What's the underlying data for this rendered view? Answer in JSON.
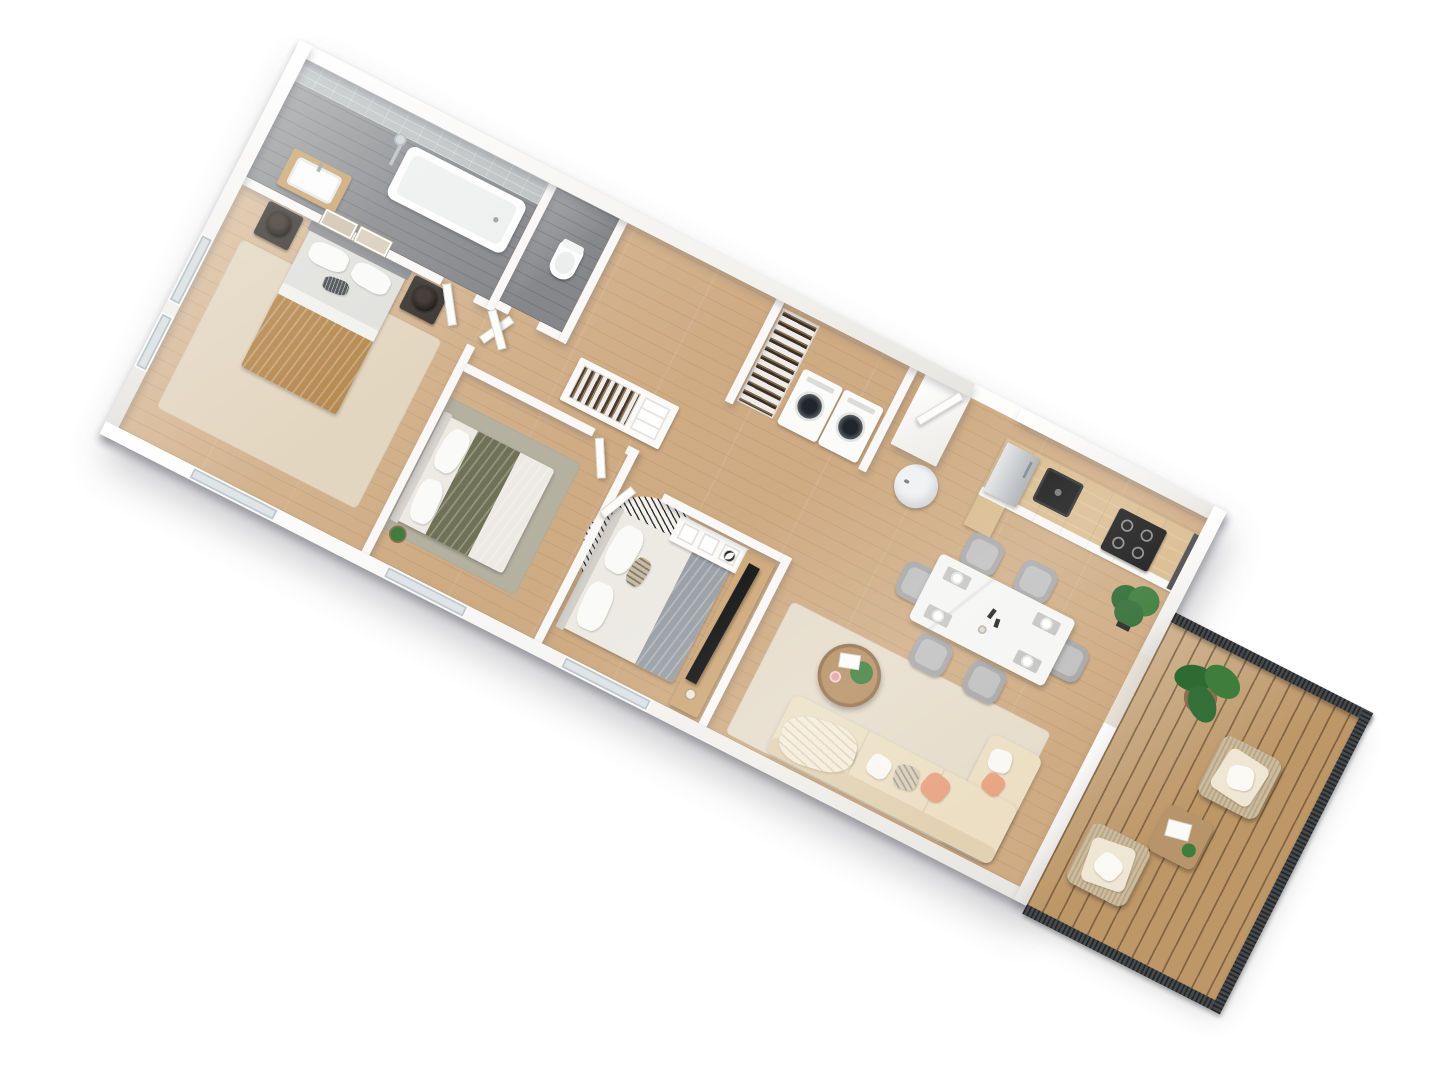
{
  "scene": {
    "type": "3d-floor-plan-render",
    "view": "top-down axonometric, rotated ~27°",
    "background": "#ffffff",
    "rooms": [
      {
        "id": "master-bedroom",
        "items": [
          "double-bed-tan-throw",
          "nightstand-left",
          "nightstand-right",
          "table-lamp-left",
          "table-lamp-right",
          "wall-art-frames-2",
          "beige-rug",
          "windows"
        ]
      },
      {
        "id": "bathroom",
        "items": [
          "bathtub",
          "shower-column",
          "vanity-sink",
          "gray-tile-wall",
          "gray-plank-floor"
        ]
      },
      {
        "id": "wc",
        "items": [
          "toilet"
        ]
      },
      {
        "id": "bedroom-2",
        "items": [
          "double-bed-olive-duvet",
          "green-gray-rug",
          "potted-plant"
        ]
      },
      {
        "id": "bedroom-3",
        "items": [
          "double-bed-gray-throw",
          "round-striped-rug-orange-skyline",
          "cube-shelf-with-dog",
          "tv-console",
          "tv"
        ]
      },
      {
        "id": "hallway",
        "items": [
          "open-wardrobe-with-clothes",
          "interior-doors"
        ]
      },
      {
        "id": "laundry-nook",
        "items": [
          "washer",
          "dryer",
          "clothes-rail",
          "water-heater",
          "duct-shaft"
        ]
      },
      {
        "id": "kitchen",
        "items": [
          "white-cabinet-run",
          "wood-countertop",
          "black-sink",
          "induction-hob-4-burners",
          "fridge-steel",
          "dark-end-panel"
        ]
      },
      {
        "id": "dining",
        "items": [
          "marble-table",
          "chairs-x6",
          "place-settings-x4",
          "candles"
        ]
      },
      {
        "id": "living-room",
        "items": [
          "corner-sofa-cream",
          "throw-blanket",
          "pillows-coral-cream",
          "round-coffee-table",
          "beige-rug",
          "fiddle-leaf-plant"
        ]
      },
      {
        "id": "balcony",
        "items": [
          "wood-deck",
          "mesh-railing",
          "banana-plant",
          "armchair-x2",
          "side-table-with-book"
        ]
      }
    ],
    "counts": {
      "bedrooms": 3,
      "dining_chairs": 6,
      "washing_machines": 2,
      "balcony_armchairs": 2,
      "wall_art_frames": 2
    }
  },
  "palette": {
    "floorWood": "#cfab83",
    "floorGray": "#85878a",
    "tileGray": "#bcc0c1",
    "wallWhite": "#f9f8f6",
    "deckWood": "#bd9768",
    "railingDark": "#46494b",
    "rugMaster": "#e3d6c0",
    "rugBedroom2": "#b5b1a1",
    "rugLiving": "#e6dccb",
    "rugRound": "#f1efe9",
    "sofaCream": "#ecdfc4",
    "sofaBack": "#e2d2b2",
    "pillowCoral": "#e8a584",
    "blanketTan": "#b5874d",
    "blanketOlive": "#6f7257",
    "blanketGray": "#9aa0a5",
    "duvetWhite": "#eceae3",
    "bedSheet": "#e0e0dd",
    "marbleWhite": "#f5f5f3",
    "chairGray": "#a7a7a7",
    "counterWood": "#d9bb8e",
    "cabinetWhite": "#f8f7f5",
    "applianceBlack": "#161616",
    "fridgeSteel": "#c3c6c9",
    "consoleWood": "#cfa97b",
    "coffeeTableWood": "#b68e62",
    "plantGreen": "#3f7d3c",
    "skylineOrange": "#d8862b",
    "heaterWhite": "#eff1f2",
    "nightstandDark": "#3a3530",
    "windowGlass": "#dfe4e6"
  }
}
